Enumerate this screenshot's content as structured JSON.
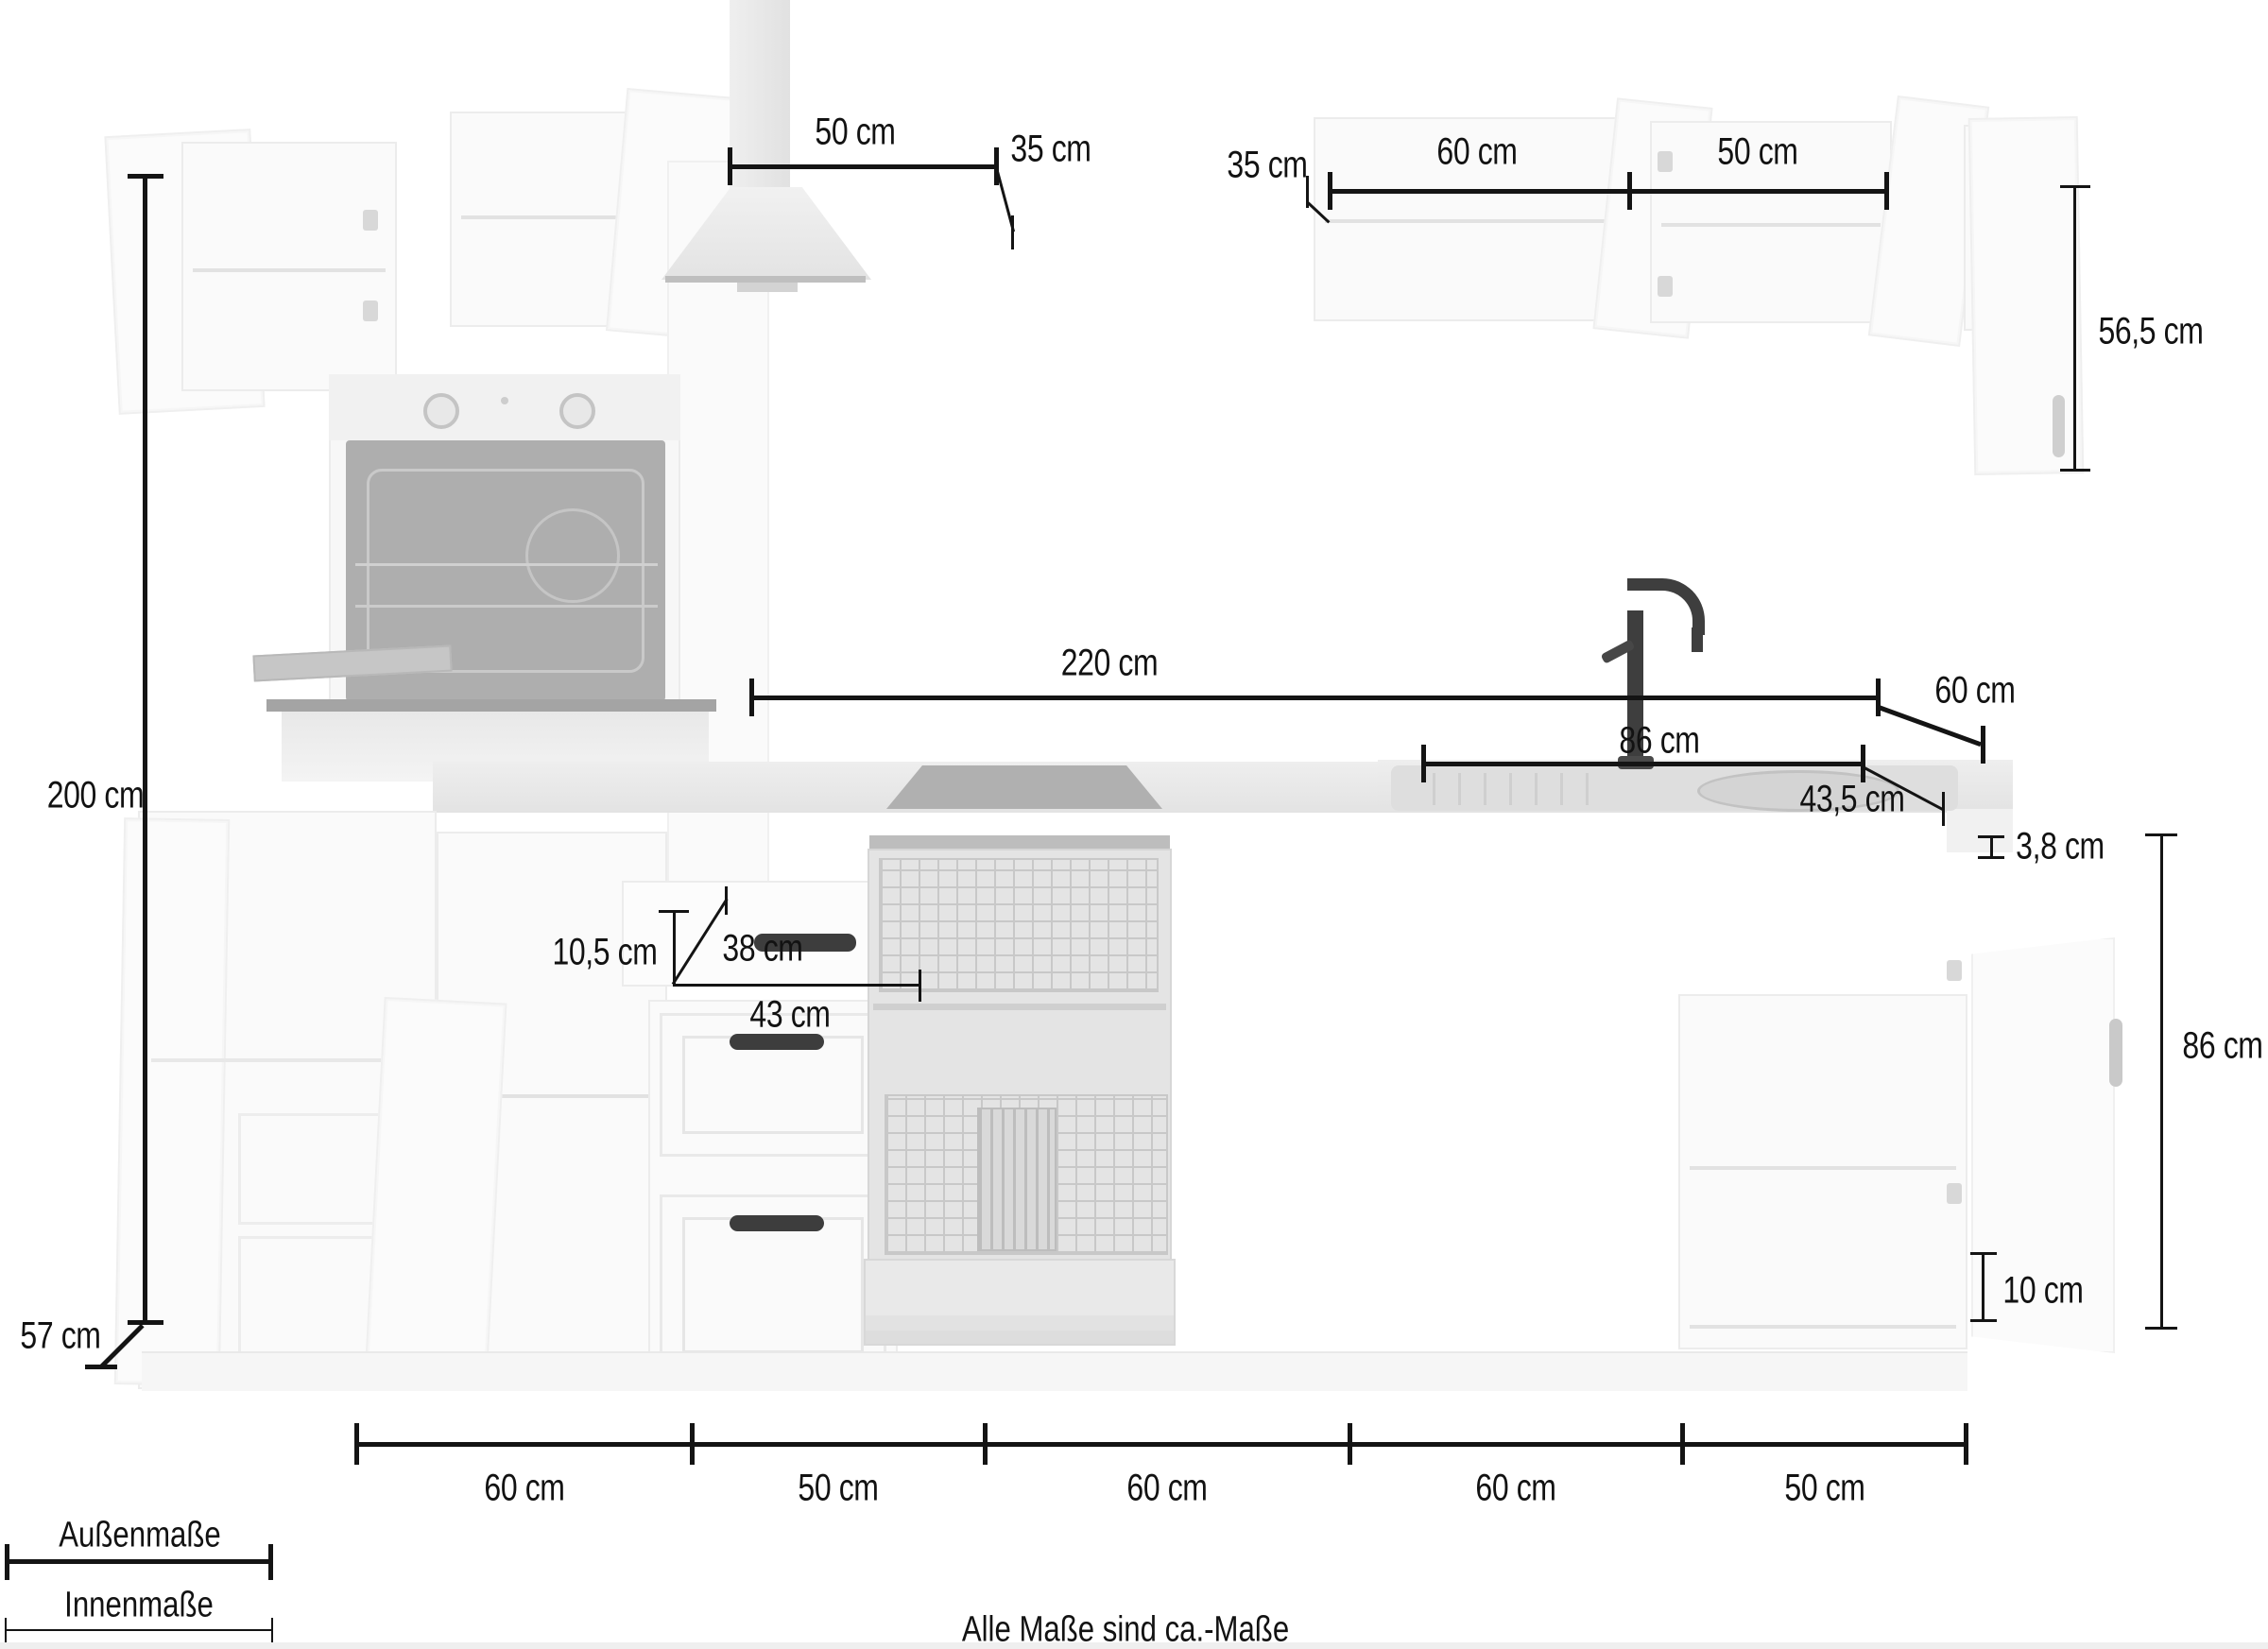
{
  "diagram": {
    "footer_note": "Alle Maße sind ca.-Maße",
    "legend": {
      "outer": "Außenmaße",
      "inner": "Innenmaße"
    },
    "colors": {
      "dimension_ink": "#141414",
      "background": "#ffffff"
    }
  },
  "dimensions": {
    "wall_cabinet_left_width": "50 cm",
    "hood_gap_left": "35 cm",
    "hood_gap_right": "35 cm",
    "wall_cabinet_right_width_60": "60 cm",
    "wall_cabinet_right_width_50": "50 cm",
    "wall_cabinet_height": "56,5 cm",
    "total_height": "200 cm",
    "worktop_run_length": "220 cm",
    "worktop_depth": "60 cm",
    "sink_cabinet_span": "86 cm",
    "sink_bowl_width": "43,5 cm",
    "worktop_thickness": "3,8 cm",
    "base_cabinet_height": "86 cm",
    "plinth_height": "10 cm",
    "drawer_front_height": "10,5 cm",
    "drawer_inner_depth": "38 cm",
    "drawer_inner_width": "43 cm",
    "cabinet_depth": "57 cm",
    "base_unit_widths": [
      "60 cm",
      "50 cm",
      "60 cm",
      "60 cm",
      "50 cm"
    ]
  }
}
